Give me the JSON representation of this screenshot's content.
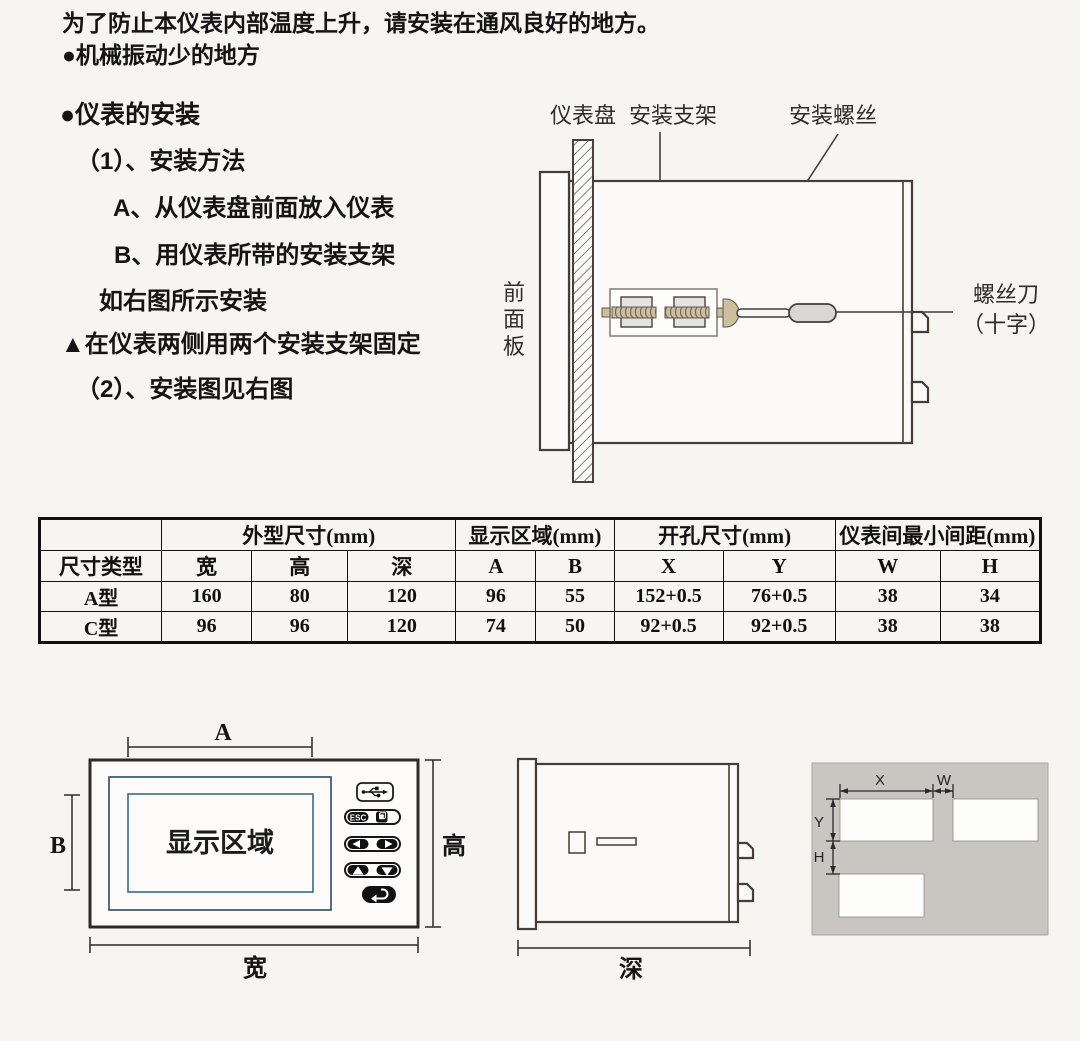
{
  "intro": {
    "line1": "为了防止本仪表内部温度上升，请安装在通风良好的地方。",
    "line2": "●机械振动少的地方"
  },
  "install": {
    "heading": "●仪表的安装",
    "step1": "（1）、安装方法",
    "item_a": "A、从仪表盘前面放入仪表",
    "item_b": "B、用仪表所带的安装支架",
    "note": "如右图所示安装",
    "warning": "▲在仪表两侧用两个安装支架固定",
    "step2": "（2）、安装图见右图"
  },
  "diagram_top": {
    "label_panel": "仪表盘",
    "label_bracket": "安装支架",
    "label_screw": "安装螺丝",
    "front_panel": [
      "前",
      "面",
      "板"
    ],
    "screwdriver_line1": "螺丝刀",
    "screwdriver_line2": "（十字）"
  },
  "table": {
    "group_headers": [
      "外型尺寸(mm)",
      "显示区域(mm)",
      "开孔尺寸(mm)",
      "仪表间最小间距(mm)"
    ],
    "sub_headers": [
      "尺寸类型",
      "宽",
      "高",
      "深",
      "A",
      "B",
      "X",
      "Y",
      "W",
      "H"
    ],
    "rows": [
      [
        "A型",
        "160",
        "80",
        "120",
        "96",
        "55",
        "152+0.5",
        "76+0.5",
        "38",
        "34"
      ],
      [
        "C型",
        "96",
        "96",
        "120",
        "74",
        "50",
        "92+0.5",
        "92+0.5",
        "38",
        "38"
      ]
    ]
  },
  "front_view": {
    "dim_a": "A",
    "dim_b": "B",
    "display_area": "显示区域",
    "esc": "ESC",
    "dim_height": "高",
    "dim_width": "宽"
  },
  "side_view": {
    "dim_depth": "深"
  },
  "cutout": {
    "dim_x": "X",
    "dim_w": "W",
    "dim_y": "Y",
    "dim_h": "H"
  },
  "icons": {
    "usb": "usb-icon",
    "page": "page-icon",
    "left": "left-arrow-icon",
    "right": "right-arrow-icon",
    "up": "up-arrow-icon",
    "down": "down-arrow-icon",
    "enter": "return-icon"
  },
  "colors": {
    "page_bg": "#f6f5f2",
    "ink": "#141414",
    "line": "#453d36",
    "display_border_outer": "#2a4b5f",
    "display_border_inner": "#356c8e",
    "panel_gray": "#c9c6c2",
    "screw_tan": "#cbbf9f",
    "handle_gray": "#d8d7d5"
  }
}
